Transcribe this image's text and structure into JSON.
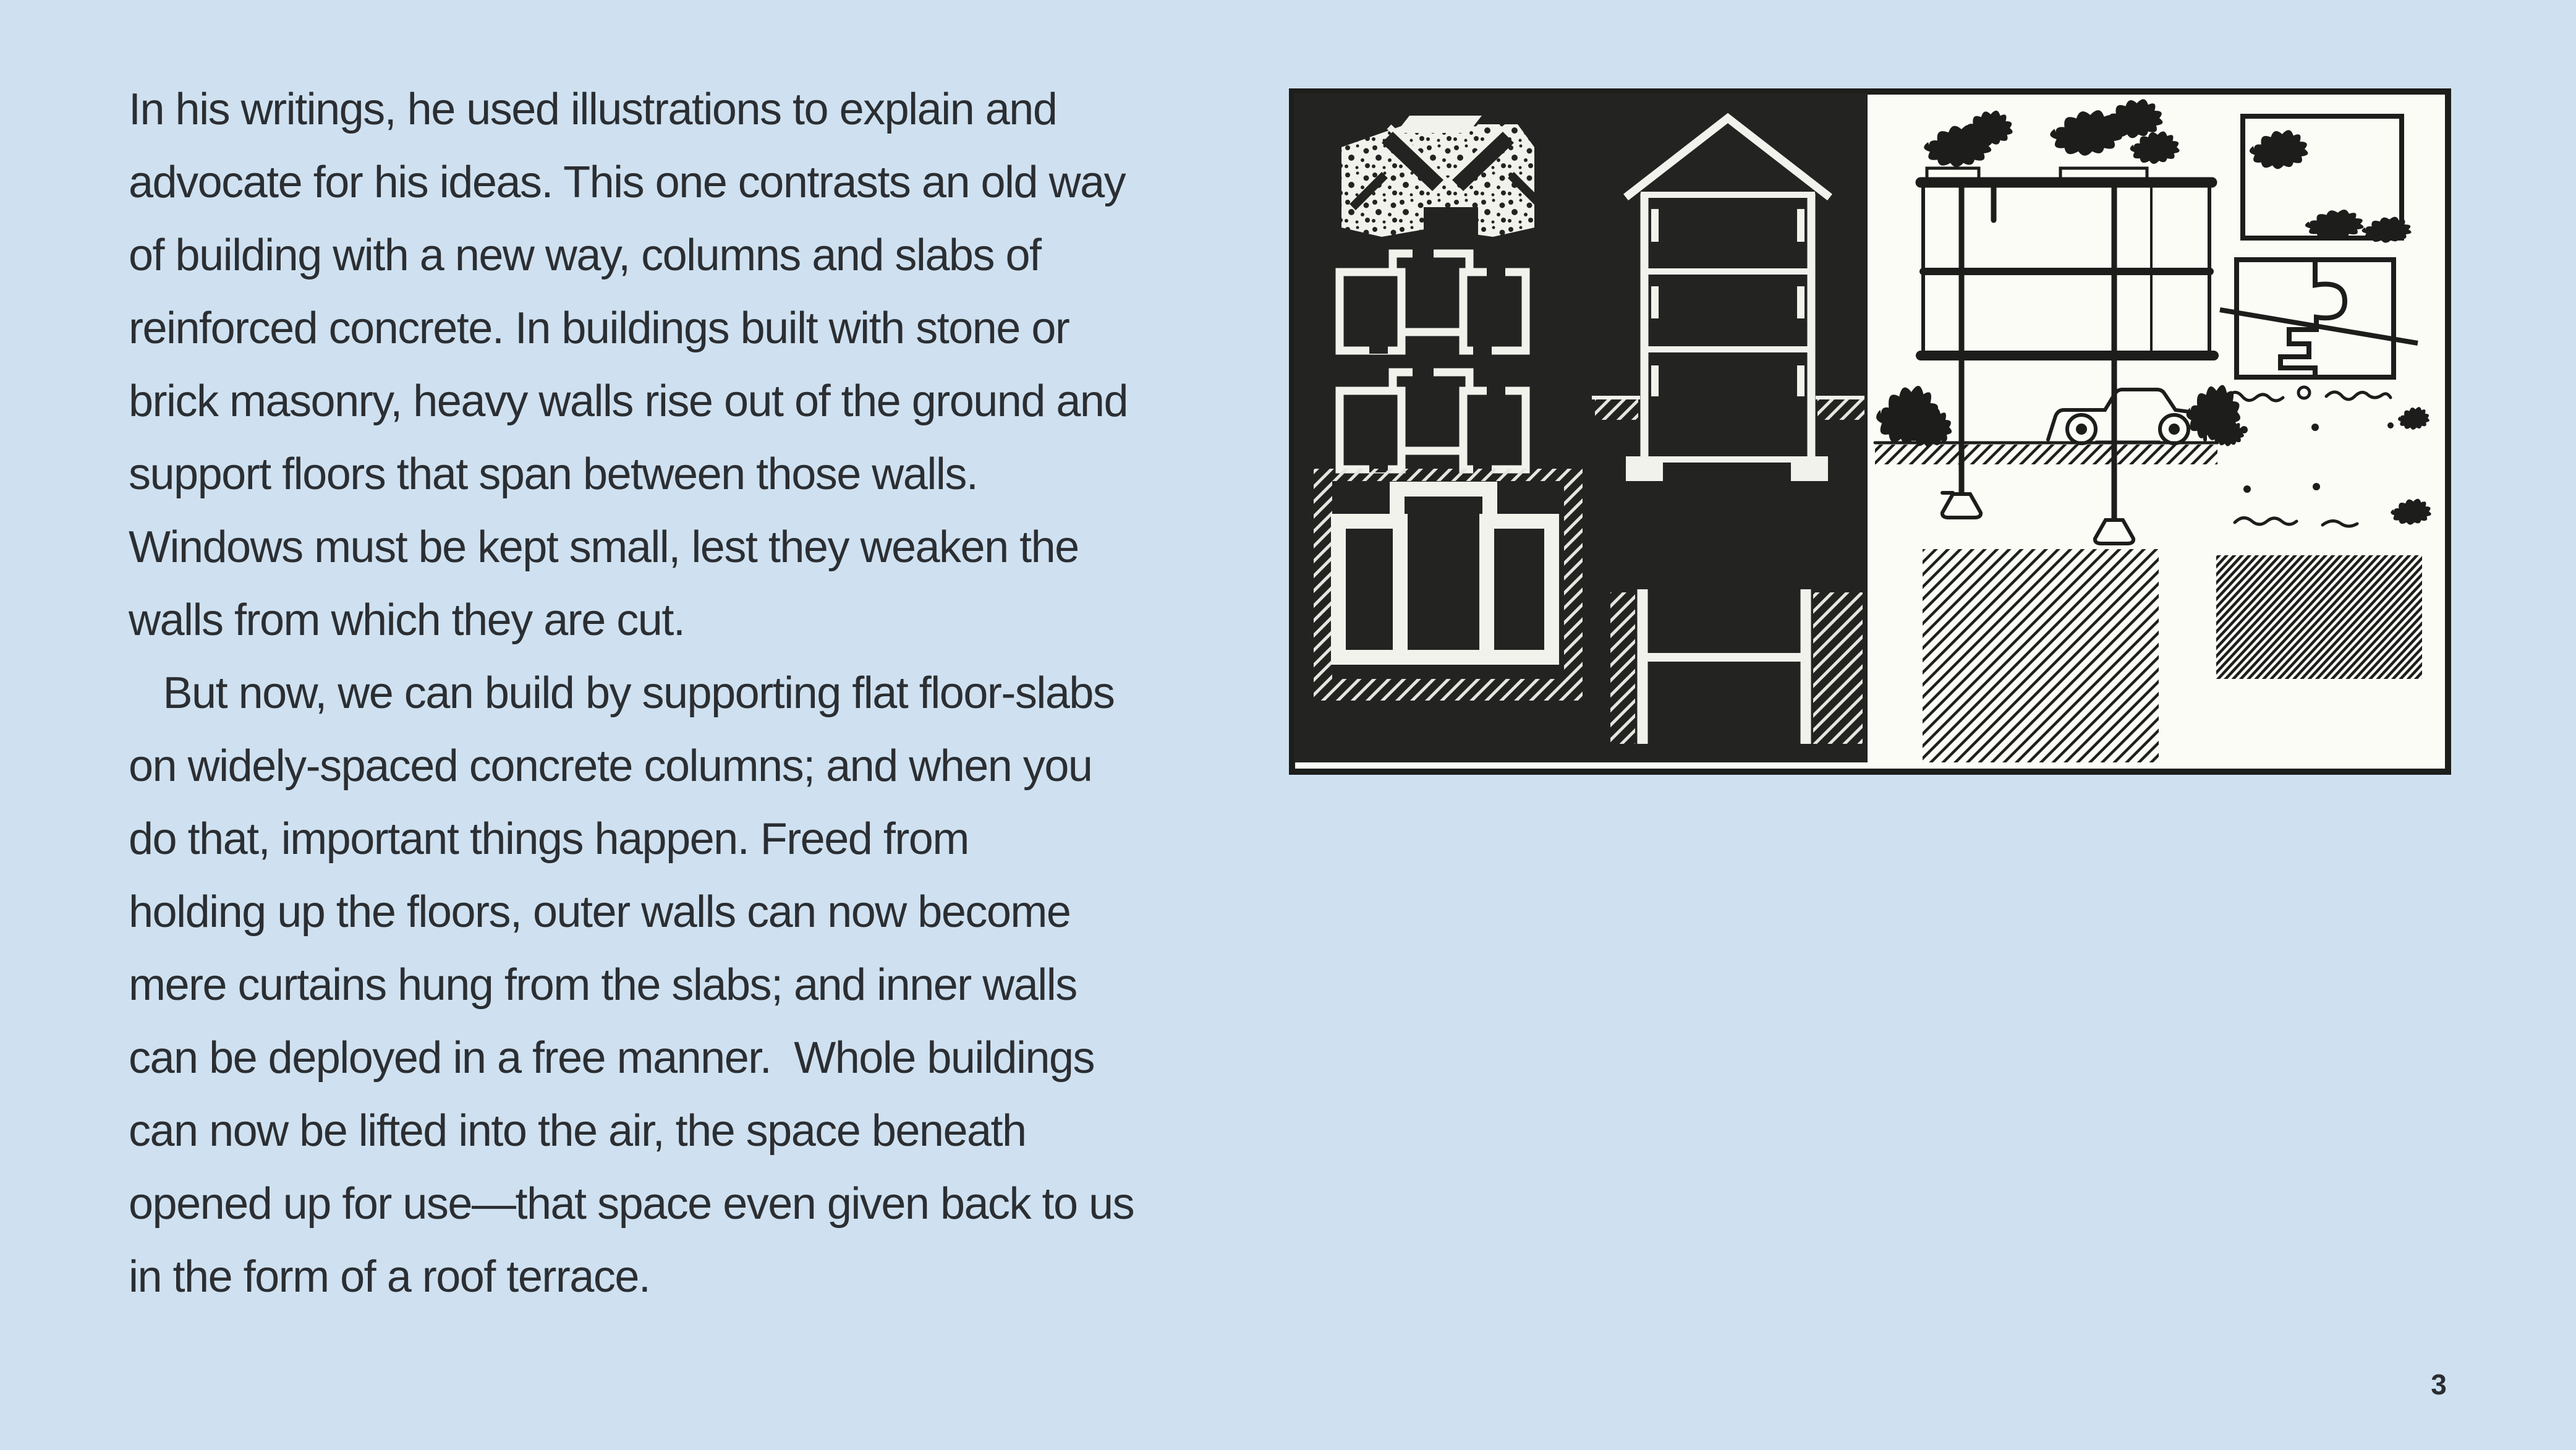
{
  "page": {
    "background_color": "#cfe1f0",
    "text_color": "#2b2e32",
    "page_number": "3"
  },
  "body_text": {
    "lines": [
      "In his writings, he used illustrations to explain and",
      "advocate for his ideas. This one contrasts an old way",
      "of building with a new way, columns and slabs of",
      "reinforced concrete. In buildings built with stone or",
      "brick masonry, heavy walls rise out of the ground and",
      "support floors that span between those walls.",
      "Windows must be kept small, lest they weaken the",
      "walls from which they are cut.",
      "   But now, we can build by supporting flat floor-slabs",
      "on widely-spaced concrete columns; and when you",
      "do that, important things happen. Freed from",
      "holding up the floors, outer walls can now become",
      "mere curtains hung from the slabs; and inner walls",
      "can be deployed in a free manner.  Whole buildings",
      "can now be lifted into the air, the space beneath",
      "opened up for use—that space even given back to us",
      "in the form of a roof terrace."
    ]
  },
  "illustration": {
    "panel_dark": "#232322",
    "panel_light": "#fcfcf7",
    "ink_dark": "#1d1d1b",
    "ink_light": "#f2f2ec"
  }
}
